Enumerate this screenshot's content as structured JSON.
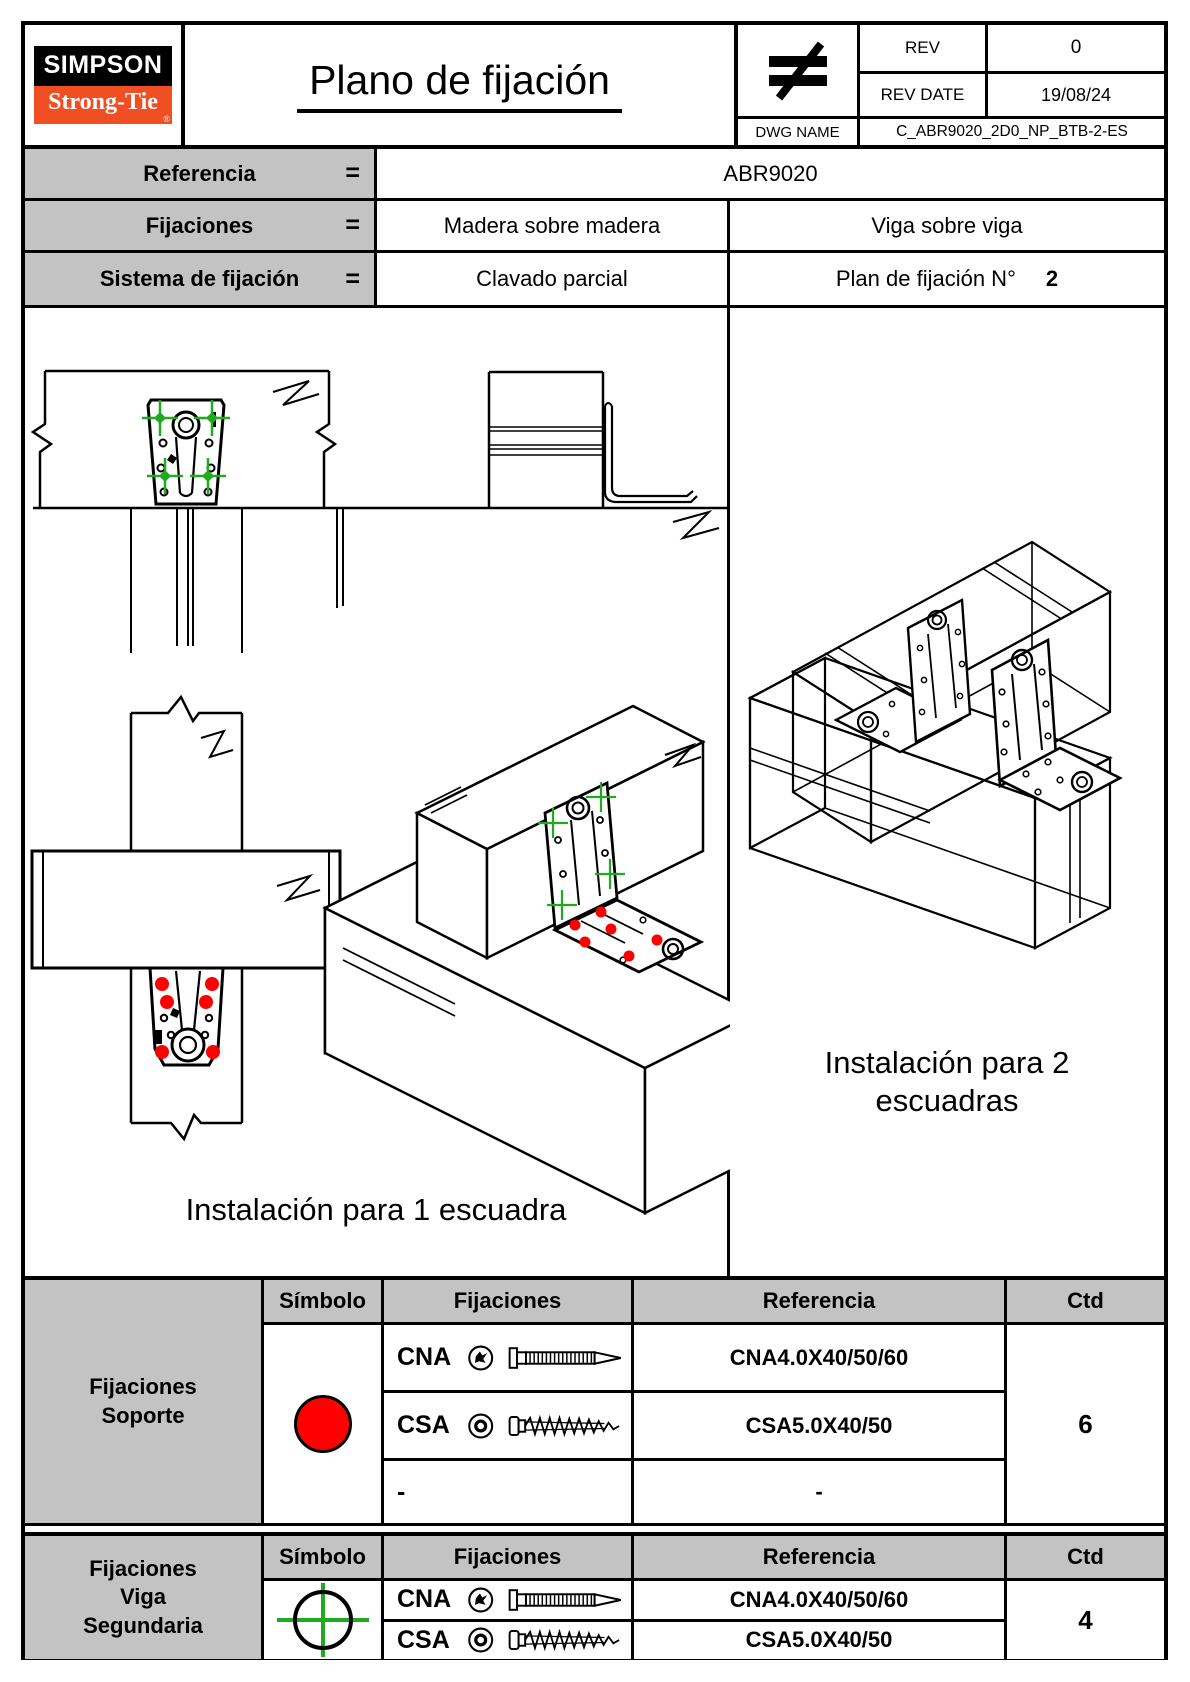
{
  "colors": {
    "brand_orange": "#f04e23",
    "fixing_red": "#ff0000",
    "fixing_green": "#1faa1f",
    "cell_gray": "#c3c3c3"
  },
  "header": {
    "logo_top": "SIMPSON",
    "logo_bottom": "Strong-Tie",
    "logo_reg": "®",
    "title": "Plano de fijación",
    "rev": {
      "label": "REV",
      "value": "0"
    },
    "rev_date": {
      "label": "REV DATE",
      "value": "19/08/24"
    },
    "dwg": {
      "label": "DWG NAME",
      "value": "C_ABR9020_2D0_NP_BTB-2-ES"
    },
    "corner_logo": "not-equal-symbol"
  },
  "info": {
    "eq": "=",
    "rows": [
      {
        "label": "Referencia",
        "value_full": "ABR9020"
      },
      {
        "label": "Fijaciones",
        "value_left": "Madera sobre madera",
        "value_right": "Viga sobre viga"
      },
      {
        "label": "Sistema de fijación",
        "value_left": "Clavado parcial",
        "value_right_label": "Plan de fijación N°",
        "value_right_number": "2"
      }
    ]
  },
  "drawings": {
    "caption_one": "Instalación para 1 escuadra",
    "caption_two_line1": "Instalación para 2",
    "caption_two_line2": "escuadras"
  },
  "table_headers": {
    "symbol": "Símbolo",
    "fixings": "Fijaciones",
    "reference": "Referencia",
    "qty": "Ctd"
  },
  "support_fixings": {
    "group_lines": [
      "Fijaciones",
      "Soporte"
    ],
    "symbol": "red-filled-circle",
    "rows": [
      {
        "code": "CNA",
        "reference": "CNA4.0X40/50/60",
        "fastener": "ring-shank-nail"
      },
      {
        "code": "CSA",
        "reference": "CSA5.0X40/50",
        "fastener": "wood-screw"
      },
      {
        "code": "-",
        "reference": "-",
        "fastener": ""
      }
    ],
    "qty": "6"
  },
  "beam_fixings": {
    "group_lines": [
      "Fijaciones",
      "Viga",
      "Segundaria"
    ],
    "symbol": "green-crosshair-circle",
    "rows": [
      {
        "code": "CNA",
        "reference": "CNA4.0X40/50/60",
        "fastener": "ring-shank-nail"
      },
      {
        "code": "CSA",
        "reference": "CSA5.0X40/50",
        "fastener": "wood-screw"
      }
    ],
    "qty": "4"
  }
}
